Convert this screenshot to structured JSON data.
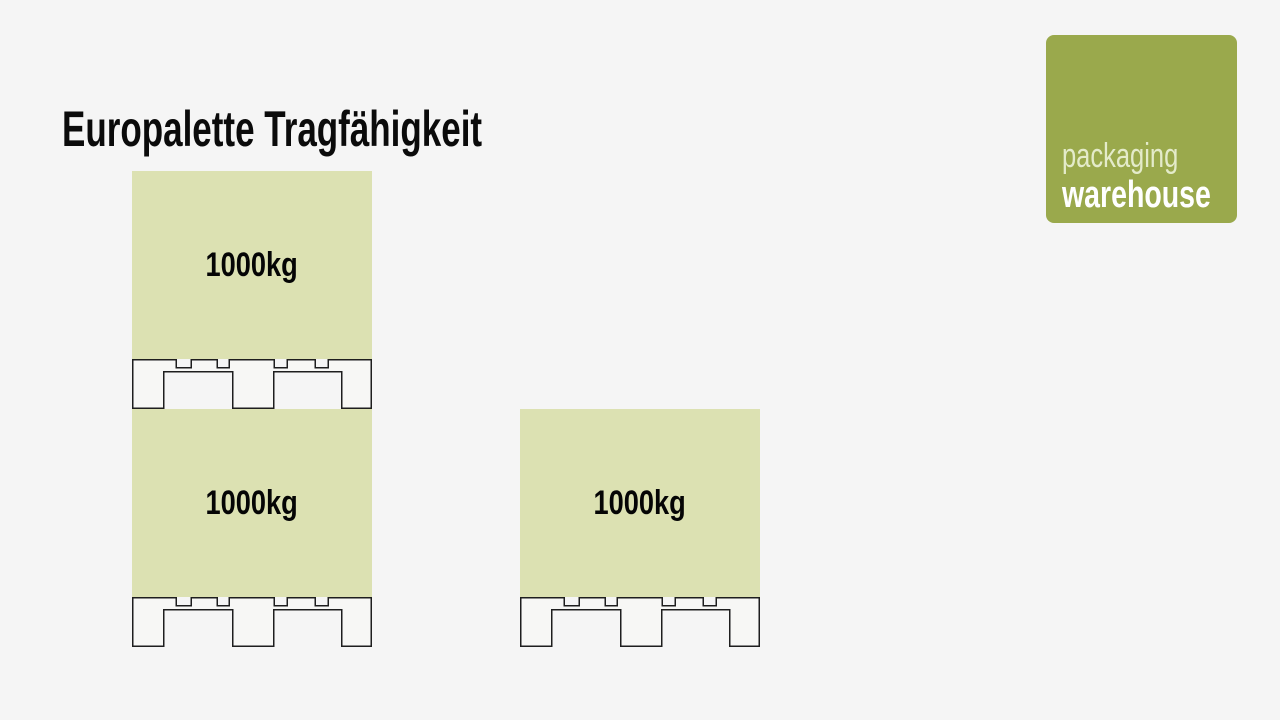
{
  "title": "Europalette Tragfähigkeit",
  "brand": {
    "line1": "packaging",
    "line2": "warehouse"
  },
  "colors": {
    "background": "#f5f5f5",
    "load_fill": "#dce1b2",
    "brand_green": "#9aa94c",
    "brand_line1_color": "#e4ebca",
    "brand_line2_color": "#ffffff",
    "pallet_outline": "#1e1e1e",
    "title_color": "#0b0b0b"
  },
  "diagram": {
    "stacks": [
      {
        "name": "double-stacked-europallets",
        "units": [
          {
            "load_label": "1000kg"
          },
          {
            "load_label": "1000kg"
          }
        ]
      },
      {
        "name": "single-europallet",
        "units": [
          {
            "load_label": "1000kg"
          }
        ]
      }
    ]
  }
}
